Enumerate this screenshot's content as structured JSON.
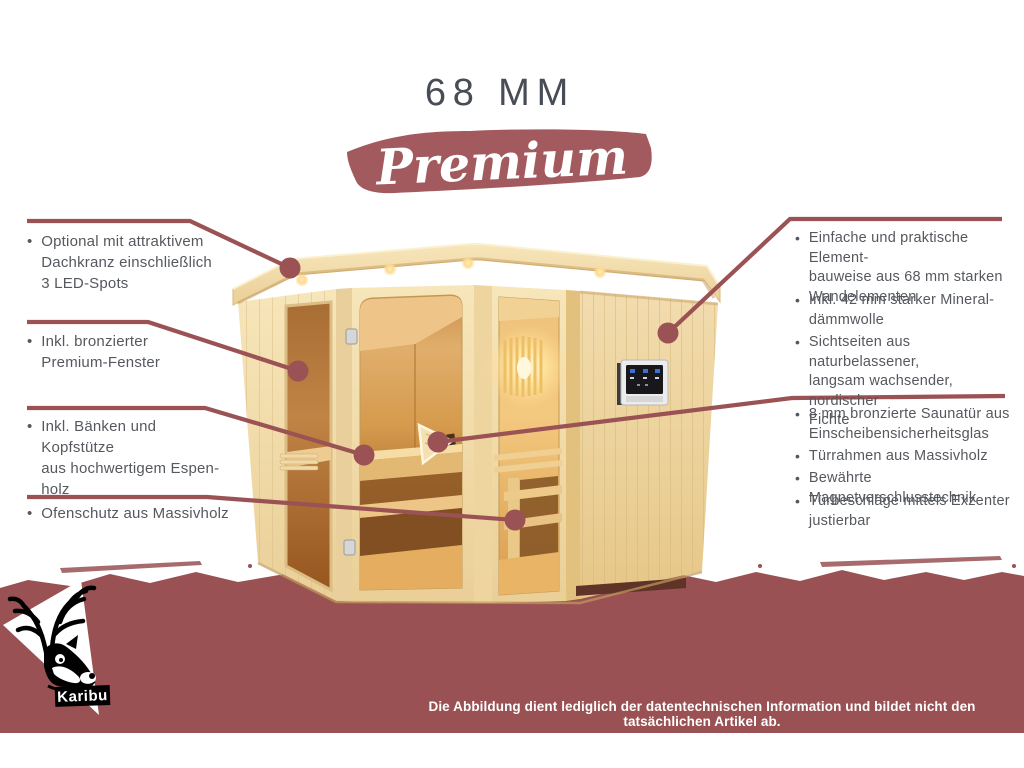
{
  "header": {
    "size_label": "68 MM",
    "series_label": "Premium"
  },
  "ui": {
    "bullet": "•"
  },
  "colors": {
    "accent_maroon": "#9b5254",
    "band_maroon": "#995153",
    "banner_maroon": "#a25a5e",
    "body_text": "#55585e",
    "title_text": "#474c55",
    "wood_light": "#f3dfae",
    "interior_glow": "#e8a84f"
  },
  "left_callouts": [
    {
      "text": "Optional mit attraktivem\nDachkranz einschließlich\n3 LED-Spots"
    },
    {
      "text": "Inkl. bronzierter\nPremium-Fenster"
    },
    {
      "text": "Inkl. Bänken und Kopfstütze\naus hochwertigem Espen-\nholz"
    },
    {
      "text": "Ofenschutz aus Massivholz"
    }
  ],
  "right_callouts_top": [
    {
      "text": "Einfache und praktische Element-\nbauweise aus 68 mm starken\nWandelementen"
    },
    {
      "text": "Inkl. 42 mm starker Mineral-\ndämmwolle"
    },
    {
      "text": "Sichtseiten aus naturbelassener,\nlangsam wachsender, nordischer\nFichte"
    }
  ],
  "right_callouts_bottom": [
    {
      "text": "8 mm bronzierte Saunatür aus\nEinscheibensicherheitsglas"
    },
    {
      "text": "Türrahmen aus Massivholz"
    },
    {
      "text": "Bewährte Magnetverschlusstechnik"
    },
    {
      "text": "Türbeschläge mittels Exzenter\njustierbar"
    }
  ],
  "footer": {
    "brand": "Karibu",
    "disclaimer": "Die Abbildung dient lediglich der datentechnischen Information und bildet nicht den tatsächlichen Artikel ab."
  }
}
